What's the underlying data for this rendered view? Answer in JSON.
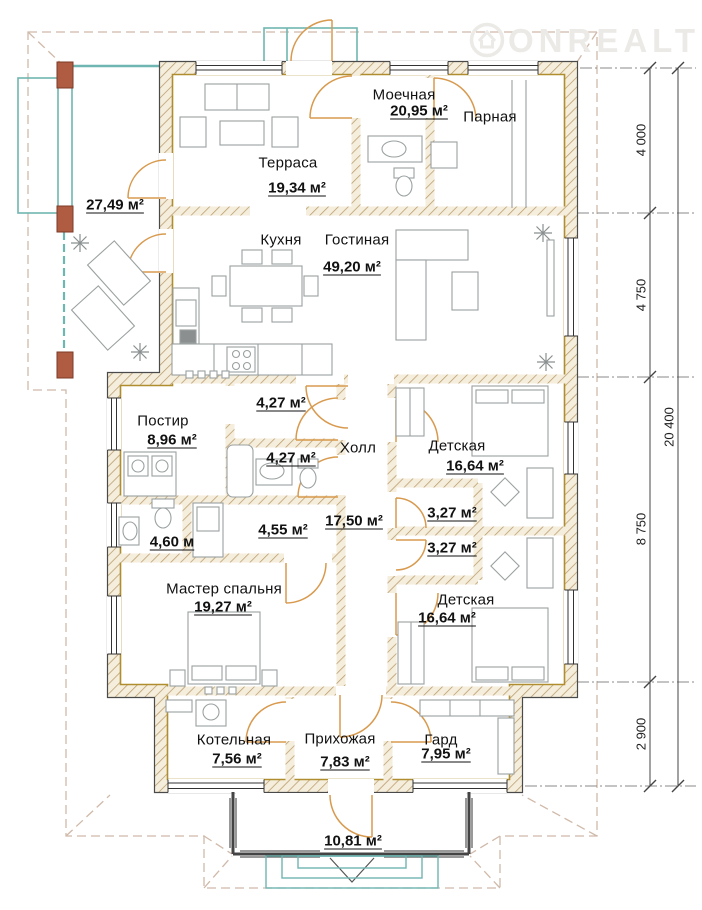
{
  "watermark": {
    "brand": "ONREALT"
  },
  "rooms": {
    "terrace_inner": {
      "name": "Терраса",
      "area": "19,34 м²"
    },
    "terrace_open": {
      "area": "27,49 м²"
    },
    "washroom": {
      "name": "Моечная",
      "area": "20,95 м²"
    },
    "sauna": {
      "name": "Парная"
    },
    "kitchen": {
      "name": "Кухня"
    },
    "living": {
      "name": "Гостиная",
      "area": "49,20 м²"
    },
    "laundry": {
      "name": "Постир",
      "area": "8,96 м²"
    },
    "wc_top": {
      "area": "4,27 м²"
    },
    "bathroom_mid": {
      "area": "4,27 м²"
    },
    "hall": {
      "name": "Холл",
      "area": "17,50 м²"
    },
    "kids_top": {
      "name": "Детская",
      "area": "16,64 м²"
    },
    "closet_top": {
      "area": "3,27 м²"
    },
    "closet_bottom": {
      "area": "3,27 м²"
    },
    "bath_small": {
      "area": "4,60 м"
    },
    "dressing": {
      "area": "4,55 м²"
    },
    "master": {
      "name": "Мастер спальня",
      "area": "19,27 м²"
    },
    "kids_bottom": {
      "name": "Детская",
      "area": "16,64 м²"
    },
    "boiler": {
      "name": "Котельная",
      "area": "7,56 м²"
    },
    "entry": {
      "name": "Прихожая",
      "area": "7,83 м²"
    },
    "wardrobe": {
      "name": "Гард",
      "area": "7,95 м²"
    },
    "porch": {
      "area": "10,81 м²"
    }
  },
  "dimensions": {
    "seg1": "4 000",
    "seg2": "4 750",
    "seg3": "8 750",
    "seg4": "2 900",
    "total": "20 400"
  },
  "colors": {
    "wall_hatch": "#b89a6a",
    "inner_line": "#b08d2f",
    "door": "#d89a4e",
    "glazing": "#6fb5b1",
    "post": "#b05c42",
    "roof_dash": "#cfb9a9"
  }
}
